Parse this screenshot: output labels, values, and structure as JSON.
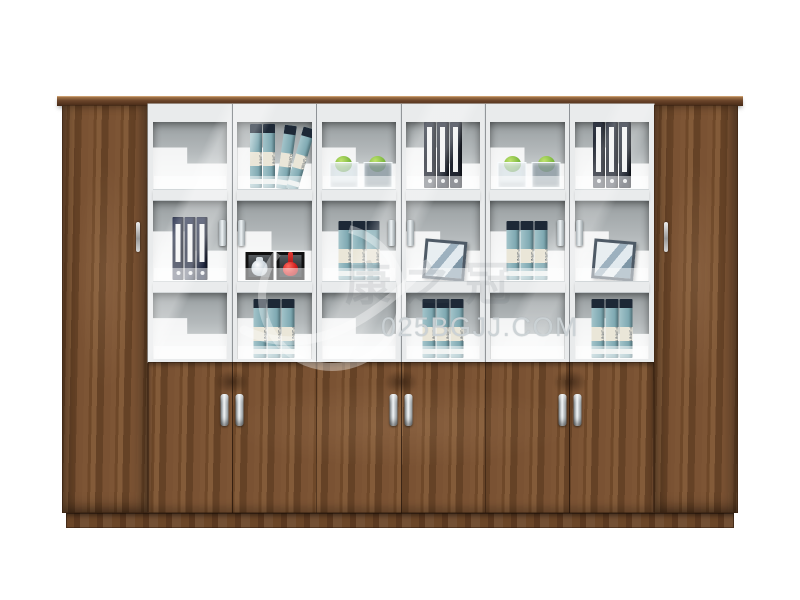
{
  "page": {
    "background_color": "#ffffff"
  },
  "watermark": {
    "url_text": "025BGJJ.COM",
    "cn_text": "康之冠",
    "logo": "swoosh-ring-icon"
  },
  "cabinet": {
    "description": "office filing cabinet / bookcase product photo",
    "structure": {
      "side_wood_doors": 2,
      "glass_doors": 6,
      "lower_wood_doors": 6,
      "shelf_rows_per_glass_door": 3,
      "has_cornice": true,
      "has_plinth": true
    },
    "colors": {
      "wood": "#7a5233",
      "wood_dark": "#5f3d24",
      "cornice": "#5a3a22",
      "frame_white": "#e9ebec",
      "interior_gray": "#b4b9bb",
      "handle_chrome": "#d7dcde"
    }
  },
  "shelves": {
    "spine_label": "FURNITURE",
    "columns": [
      {
        "rows": [
          "empty",
          "binders-navy",
          "empty"
        ]
      },
      {
        "rows": [
          "books-lean",
          "vases",
          "books-teal"
        ]
      },
      {
        "rows": [
          "apple-cups",
          "books-teal",
          "empty"
        ]
      },
      {
        "rows": [
          "binders-dark",
          "frame",
          "books-teal"
        ]
      },
      {
        "rows": [
          "apple-cups",
          "books-teal",
          "empty"
        ]
      },
      {
        "rows": [
          "binders-dark",
          "frame",
          "books-teal"
        ]
      }
    ],
    "item_legend": {
      "empty": "empty shelf cell",
      "binders-navy": "3 navy lever-arch files with white spine labels",
      "binders-dark": "3 black lever-arch files with white spine labels",
      "books-teal": "3 teal decorative books with dark tops and cream label bands",
      "books-lean": "4 teal decorative books, last ones leaning",
      "apple-cups": "2 glass cube vessels each holding a green apple",
      "vases": "2 black display cubes holding a white vase and a red vase",
      "frame": "leaning picture frame with blue-grey abstract print"
    }
  }
}
